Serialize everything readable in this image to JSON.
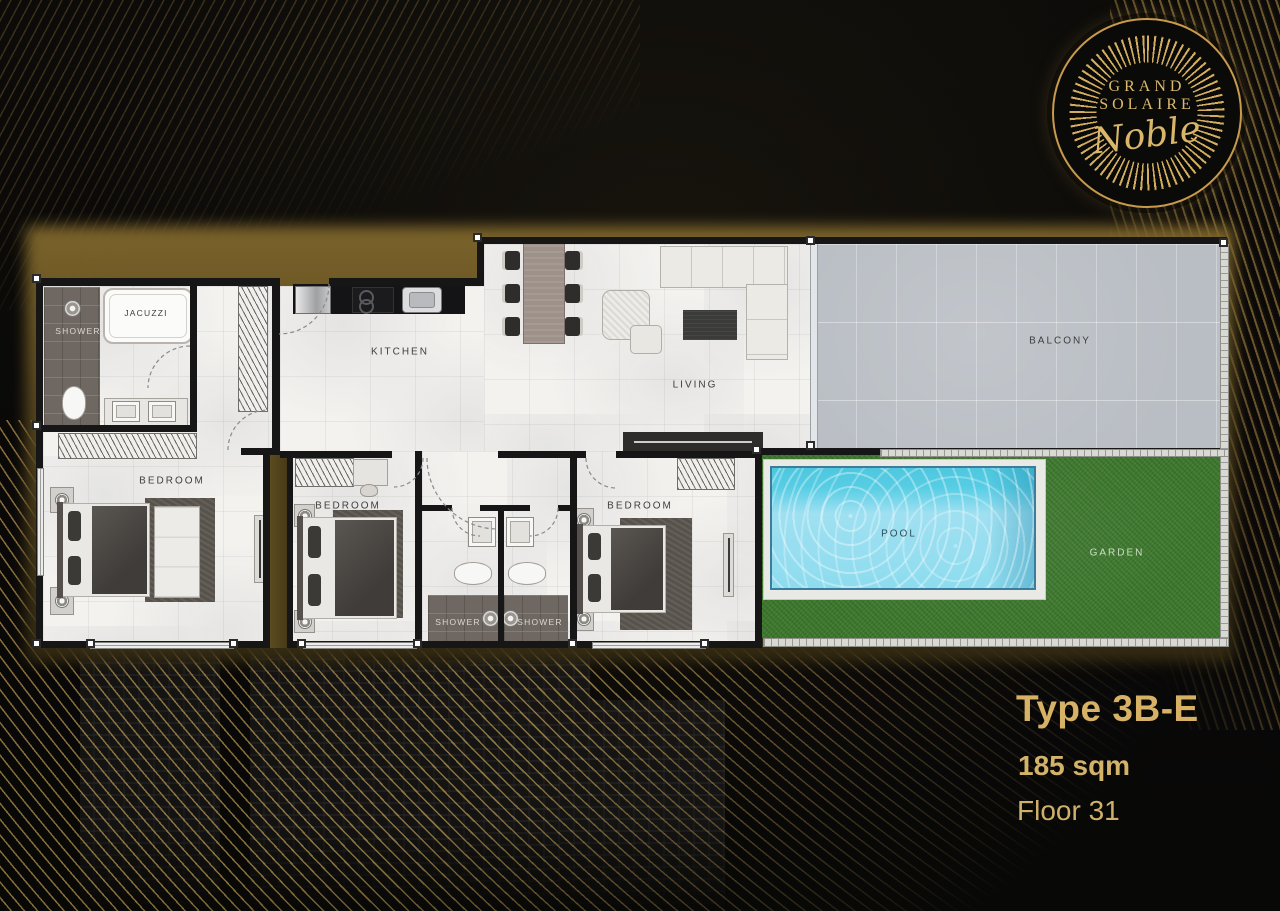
{
  "brand": {
    "name_line1": "GRAND",
    "name_line2": "SOLAIRE",
    "script": "Noble"
  },
  "unit": {
    "type": "Type 3B-E",
    "area": "185 sqm",
    "floor": "Floor 31"
  },
  "labels": {
    "kitchen": "KITCHEN",
    "living": "LIVING",
    "balcony": "BALCONY",
    "bedroom_master": "BEDROOM",
    "bedroom_2": "BEDROOM",
    "bedroom_3": "BEDROOM",
    "shower_master": "SHOWER",
    "shower_1": "SHOWER",
    "shower_2": "SHOWER",
    "jacuzzi": "JACUZZI",
    "pool": "POOL",
    "garden": "GARDEN"
  },
  "palette": {
    "gold": "#d3ae62",
    "wall": "#161616",
    "floor": "#f3f2ef",
    "water": "#8edcef",
    "grass": "#3e7a2e",
    "balcony_tile": "#b9bec4",
    "dark_tile": "#6f6862"
  }
}
